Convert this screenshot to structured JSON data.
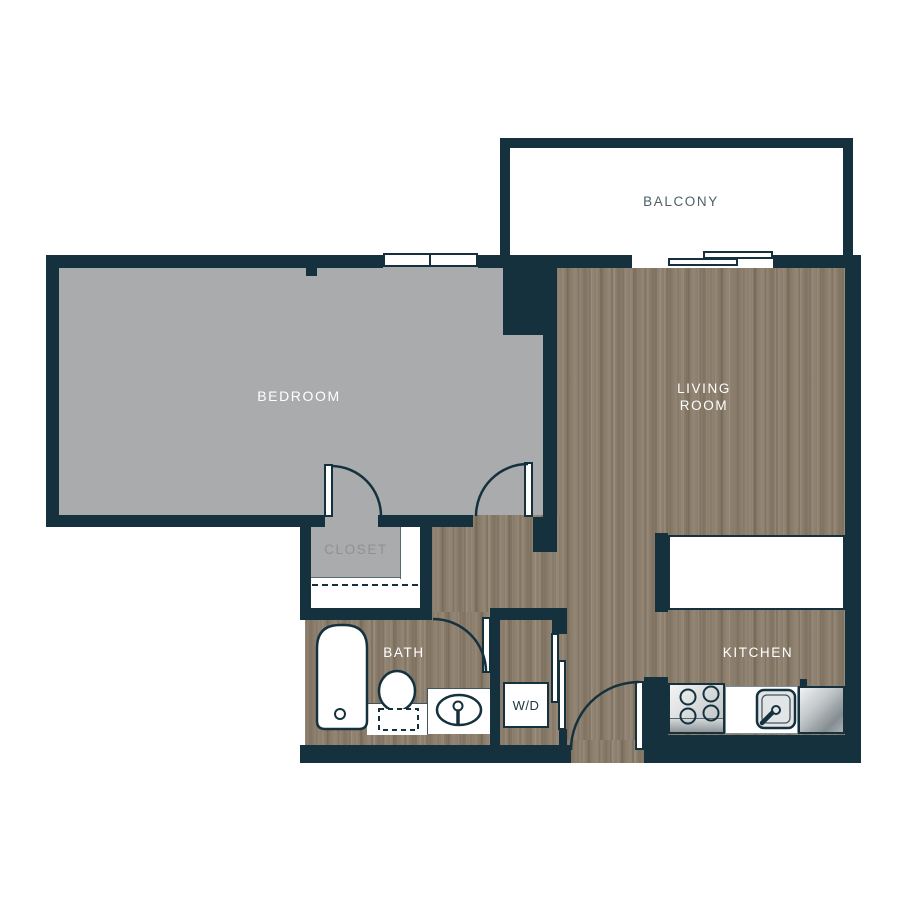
{
  "plan": {
    "type": "apartment-floor-plan",
    "rooms": {
      "balcony_label": "BALCONY",
      "bedroom_label": "BEDROOM",
      "living_room_line1": "LIVING",
      "living_room_line2": "ROOM",
      "closet_label": "CLOSET",
      "bath_label": "BATH",
      "washer_dryer_label": "W/D",
      "kitchen_label": "KITCHEN"
    },
    "colors": {
      "wall": "#16313e",
      "bedroom_carpet": "#a9abad",
      "wood_floor": "#8b7d6b",
      "balcony_floor": "#ffffff",
      "room_label_light": "#ffffff",
      "closet_label_gray": "#8e9194",
      "balcony_label_dark": "#4e5f69"
    },
    "fixtures": [
      "bedroom-window",
      "balcony-sliding-door",
      "breakfast-counter",
      "closet-shelf-dashed-rod",
      "bathtub",
      "toilet",
      "vanity-sink",
      "washer-dryer",
      "stove-four-burners",
      "kitchen-sink",
      "refrigerator",
      "closet-door",
      "bedroom-hall-door",
      "bath-door",
      "wd-bypass-doors",
      "entry-door"
    ]
  }
}
